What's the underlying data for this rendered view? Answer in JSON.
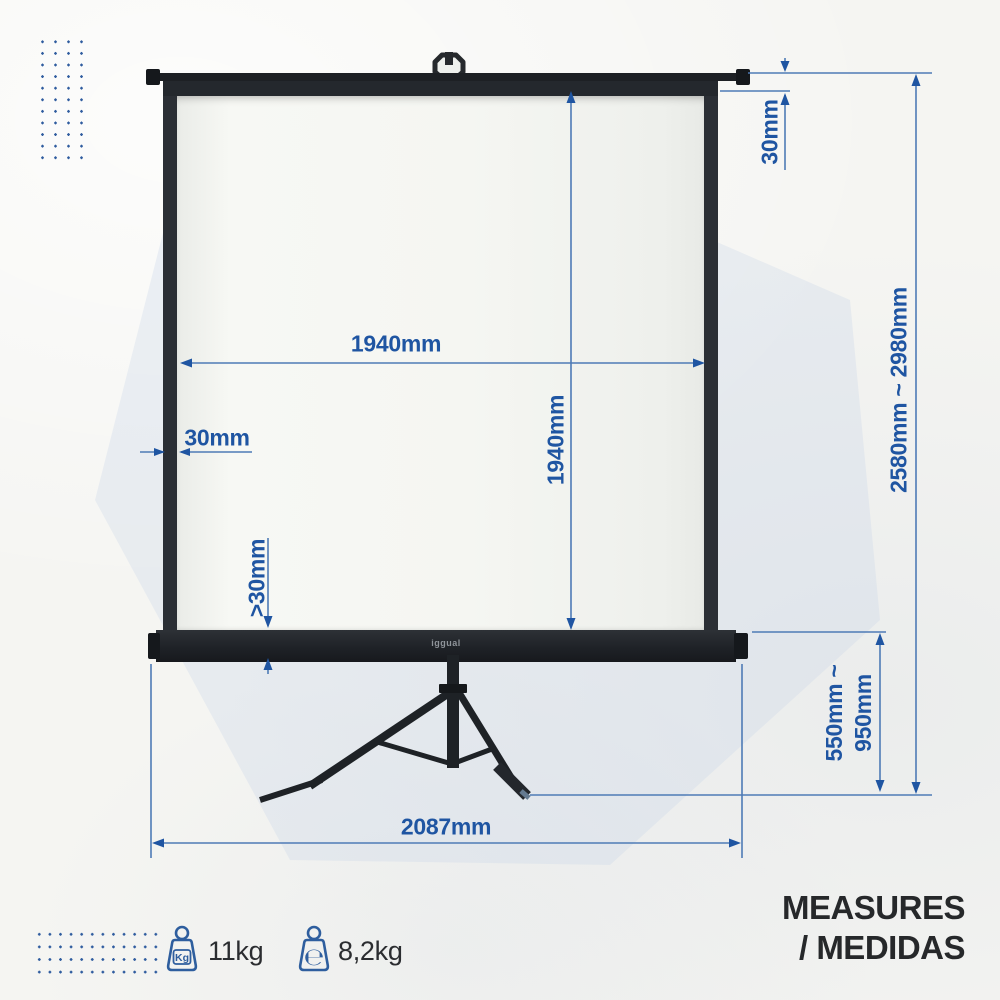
{
  "colors": {
    "dim_text": "#1f55a2",
    "dim_line": "#4e7bb6",
    "product_dark": "#22262b",
    "background": "#f5f5f2"
  },
  "brand": {
    "logo": "iggual"
  },
  "dimensions": {
    "screen_width": "1940mm",
    "screen_height": "1940mm",
    "left_border": "30mm",
    "top_border": "30mm",
    "bottom_border": ">30mm",
    "total_height": "2580mm ~ 2980mm",
    "stand_height_min": "550mm ~",
    "stand_height_max": "950mm",
    "base_width": "2087mm"
  },
  "footer": {
    "kg_badge": "Kg",
    "gross_weight": "11kg",
    "estimated_badge": "℮",
    "net_weight": "8,2kg",
    "title_line1": "MEASURES",
    "title_line2": "/ MEDIDAS"
  }
}
